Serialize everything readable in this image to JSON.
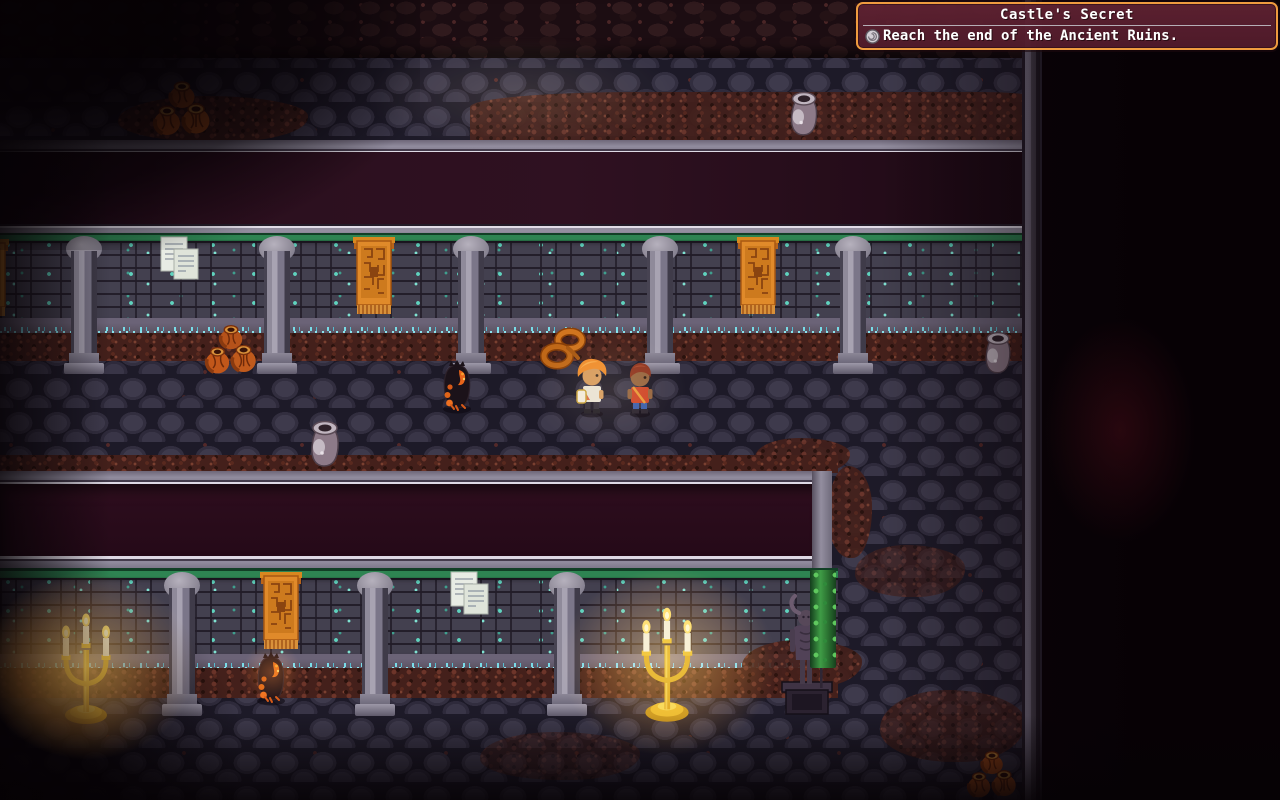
{
  "scene": {
    "name": "ancient-ruins-dungeon",
    "description": "Top-down pixel RPG dungeon corridor with stone walls, pillars, banners and torch-lit alcoves"
  },
  "quest": {
    "title": "Castle's Secret",
    "objective": "Reach the end of the Ancient Ruins.",
    "icon": "spiral-badge-icon",
    "colors": {
      "border": "#ef9b3f",
      "background": "#5a1f2e",
      "text": "#ffffff",
      "separator": "#b6aeb6"
    }
  },
  "palette": {
    "floor_stone": "#393547",
    "floor_gap": "#1d1a28",
    "gravel_red": "#59291f",
    "wall_brick": "#43404f",
    "wall_moss_teal": "#5fd3be",
    "wall_top_moss": "#2e8452",
    "ledge_gray": "#918c9e",
    "banner_orange": "#e08a2a",
    "candle_gold": "#eab127",
    "void_dark": "#0a0309"
  },
  "entities": [
    {
      "name": "pillar-upper-1",
      "type": "pillar",
      "x": 62,
      "y": 236,
      "w": 44,
      "h": 138,
      "interactable": false
    },
    {
      "name": "pillar-upper-2",
      "type": "pillar",
      "x": 255,
      "y": 236,
      "w": 44,
      "h": 138,
      "interactable": false
    },
    {
      "name": "pillar-upper-3",
      "type": "pillar",
      "x": 449,
      "y": 236,
      "w": 44,
      "h": 138,
      "interactable": false
    },
    {
      "name": "pillar-upper-4",
      "type": "pillar",
      "x": 638,
      "y": 236,
      "w": 44,
      "h": 138,
      "interactable": false
    },
    {
      "name": "pillar-upper-5",
      "type": "pillar",
      "x": 831,
      "y": 236,
      "w": 44,
      "h": 138,
      "interactable": false
    },
    {
      "name": "pillar-lower-1",
      "type": "pillar",
      "x": 160,
      "y": 572,
      "w": 44,
      "h": 144,
      "interactable": false
    },
    {
      "name": "pillar-lower-2",
      "type": "pillar",
      "x": 353,
      "y": 572,
      "w": 44,
      "h": 144,
      "interactable": false
    },
    {
      "name": "pillar-lower-3",
      "type": "pillar",
      "x": 545,
      "y": 572,
      "w": 44,
      "h": 144,
      "interactable": false
    },
    {
      "name": "banner-left-edge",
      "type": "banner",
      "x": -33,
      "y": 239,
      "w": 42,
      "h": 80,
      "interactable": false
    },
    {
      "name": "banner-upper-1",
      "type": "banner",
      "x": 353,
      "y": 237,
      "w": 42,
      "h": 80,
      "interactable": false
    },
    {
      "name": "banner-upper-2",
      "type": "banner",
      "x": 737,
      "y": 237,
      "w": 42,
      "h": 80,
      "interactable": false
    },
    {
      "name": "banner-lower-1",
      "type": "banner",
      "x": 260,
      "y": 572,
      "w": 42,
      "h": 80,
      "interactable": false
    },
    {
      "name": "wall-notes-upper",
      "type": "papers",
      "x": 160,
      "y": 236,
      "w": 42,
      "h": 48,
      "interactable": true
    },
    {
      "name": "wall-notes-lower",
      "type": "papers",
      "x": 450,
      "y": 571,
      "w": 42,
      "h": 48,
      "interactable": true
    },
    {
      "name": "clay-pots-top-left",
      "type": "pots-orange",
      "x": 150,
      "y": 80,
      "w": 64,
      "h": 58,
      "interactable": true
    },
    {
      "name": "clay-pots-mid-corridor",
      "type": "pots-orange",
      "x": 204,
      "y": 322,
      "w": 54,
      "h": 56,
      "interactable": true
    },
    {
      "name": "clay-pots-bottom-right",
      "type": "pots-orange",
      "x": 966,
      "y": 750,
      "w": 52,
      "h": 50,
      "interactable": true
    },
    {
      "name": "ceramic-pot-top",
      "type": "gray-pot",
      "x": 785,
      "y": 88,
      "w": 38,
      "h": 50,
      "interactable": true
    },
    {
      "name": "ceramic-pot-right",
      "type": "gray-pot",
      "x": 980,
      "y": 326,
      "w": 36,
      "h": 52,
      "interactable": true
    },
    {
      "name": "ceramic-pot-mid",
      "type": "gray-pot",
      "x": 305,
      "y": 416,
      "w": 40,
      "h": 54,
      "interactable": true
    },
    {
      "name": "rope-coil",
      "type": "rope",
      "x": 540,
      "y": 327,
      "w": 48,
      "h": 45,
      "interactable": true
    },
    {
      "name": "shadow-imp-upper",
      "type": "imp",
      "x": 436,
      "y": 356,
      "w": 42,
      "h": 58,
      "interactable": true
    },
    {
      "name": "shadow-imp-lower",
      "type": "imp",
      "x": 250,
      "y": 648,
      "w": 42,
      "h": 58,
      "interactable": true
    },
    {
      "name": "hero-character",
      "type": "hero",
      "x": 572,
      "y": 355,
      "w": 40,
      "h": 63,
      "interactable": true
    },
    {
      "name": "companion-character",
      "type": "companion",
      "x": 621,
      "y": 359,
      "w": 38,
      "h": 59,
      "interactable": true
    },
    {
      "name": "candelabra-left",
      "type": "candelabra",
      "x": 54,
      "y": 612,
      "w": 64,
      "h": 114,
      "interactable": false
    },
    {
      "name": "candelabra-right",
      "type": "candelabra",
      "x": 634,
      "y": 606,
      "w": 66,
      "h": 118,
      "interactable": false
    },
    {
      "name": "demon-statue",
      "type": "statue",
      "x": 780,
      "y": 582,
      "w": 54,
      "h": 136,
      "interactable": true
    },
    {
      "name": "ivy-corner",
      "type": "ivy-strip",
      "x": 810,
      "y": 570,
      "w": 26,
      "h": 98,
      "interactable": false
    },
    {
      "name": "glow-candelabra-left",
      "type": "glow-warm",
      "x": -62,
      "y": 536,
      "w": 300,
      "h": 260,
      "interactable": false
    },
    {
      "name": "glow-candelabra-right",
      "type": "glow-warm",
      "x": 518,
      "y": 532,
      "w": 300,
      "h": 260,
      "interactable": false
    },
    {
      "name": "glow-party-light",
      "type": "glow-soft",
      "x": 500,
      "y": 305,
      "w": 220,
      "h": 170,
      "interactable": false
    },
    {
      "name": "glow-top-corridor",
      "type": "glow-soft",
      "x": 300,
      "y": 10,
      "w": 440,
      "h": 170,
      "interactable": false
    },
    {
      "name": "glow-imp-ember",
      "type": "glow-ember",
      "x": 230,
      "y": 630,
      "w": 84,
      "h": 84,
      "interactable": false
    }
  ]
}
